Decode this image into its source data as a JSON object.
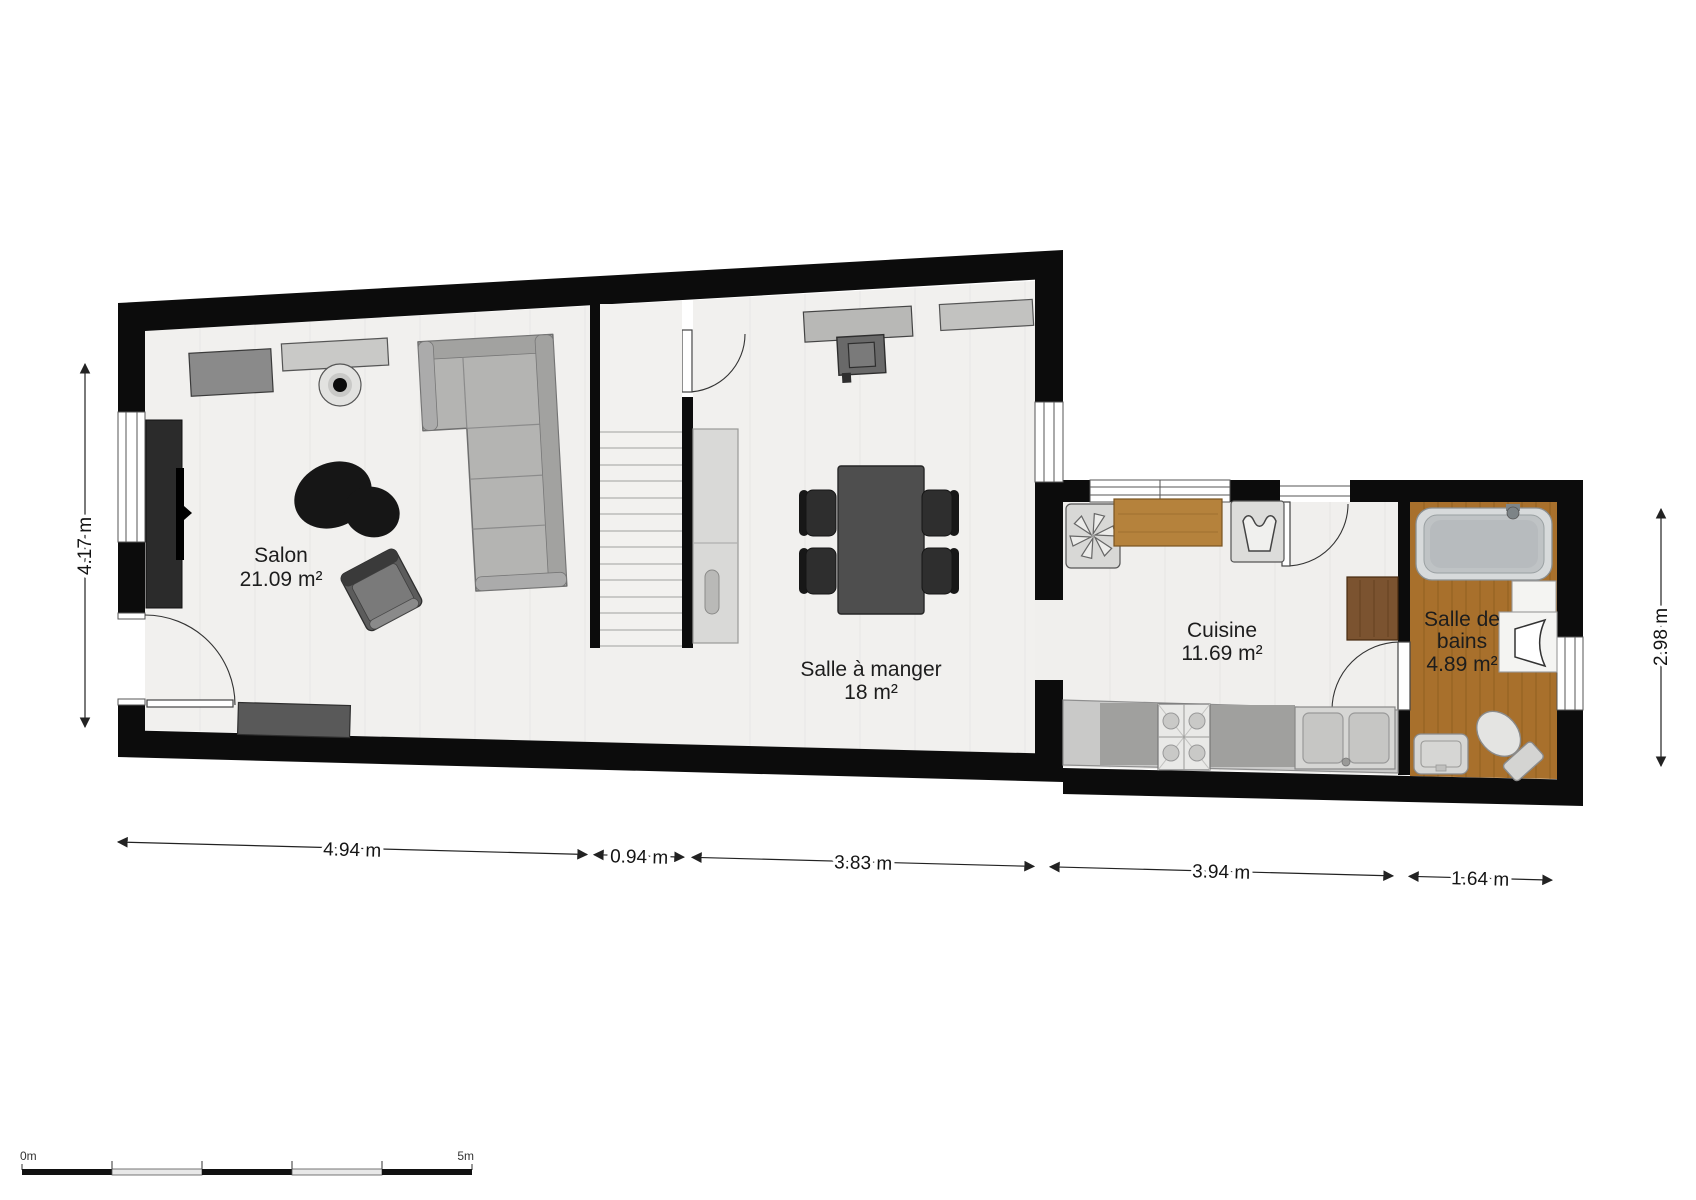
{
  "floorplan": {
    "title": "Floor plan – ground floor",
    "rooms": [
      {
        "name": "Salon",
        "area": "21.09 m²",
        "label_lines": [
          "Salon",
          "21.09 m²"
        ]
      },
      {
        "name": "Salle à manger",
        "area": "18 m²",
        "label_lines": [
          "Salle à manger",
          "18 m²"
        ]
      },
      {
        "name": "Cuisine",
        "area": "11.69 m²",
        "label_lines": [
          "Cuisine",
          "11.69 m²"
        ]
      },
      {
        "name": "Salle de bains",
        "area": "4.89 m²",
        "label_lines": [
          "Salle de",
          "bains",
          "4.89 m²"
        ]
      }
    ],
    "dimensions_bottom": [
      {
        "label": "4.94 m"
      },
      {
        "label": "0.94 m"
      },
      {
        "label": "3.83 m"
      },
      {
        "label": "3.94 m"
      },
      {
        "label": "1.64 m"
      }
    ],
    "dimension_left": {
      "label": "4.17 m"
    },
    "dimension_right": {
      "label": "2.98 m"
    },
    "scale_bar": {
      "start_label": "0m",
      "end_label": "5m"
    },
    "colors": {
      "wall": "#0c0c0c",
      "floor": "#f1f0ee",
      "wood_floor": "#a8702c",
      "counter_wood": "#b5823c",
      "dark_wood": "#7b5330",
      "dimension": "#222222"
    },
    "furniture_icons": [
      "sofa-icon",
      "armchair-icon",
      "rug-icon",
      "tv-unit-icon",
      "sideboard-icon",
      "wall-shelf-icon",
      "speaker-icon",
      "bench-icon",
      "entry-door-icon",
      "stairs-icon",
      "tall-cabinet-icon",
      "fireplace-icon",
      "dining-table-icon",
      "dining-chair-icon",
      "fridge-freezer-icon",
      "kitchen-counter-icon",
      "washing-machine-icon",
      "stove-icon",
      "kitchen-sink-icon",
      "side-cabinet-icon",
      "bathtub-icon",
      "washbasin-icon",
      "toilet-icon",
      "bath-cabinet-icon"
    ]
  }
}
